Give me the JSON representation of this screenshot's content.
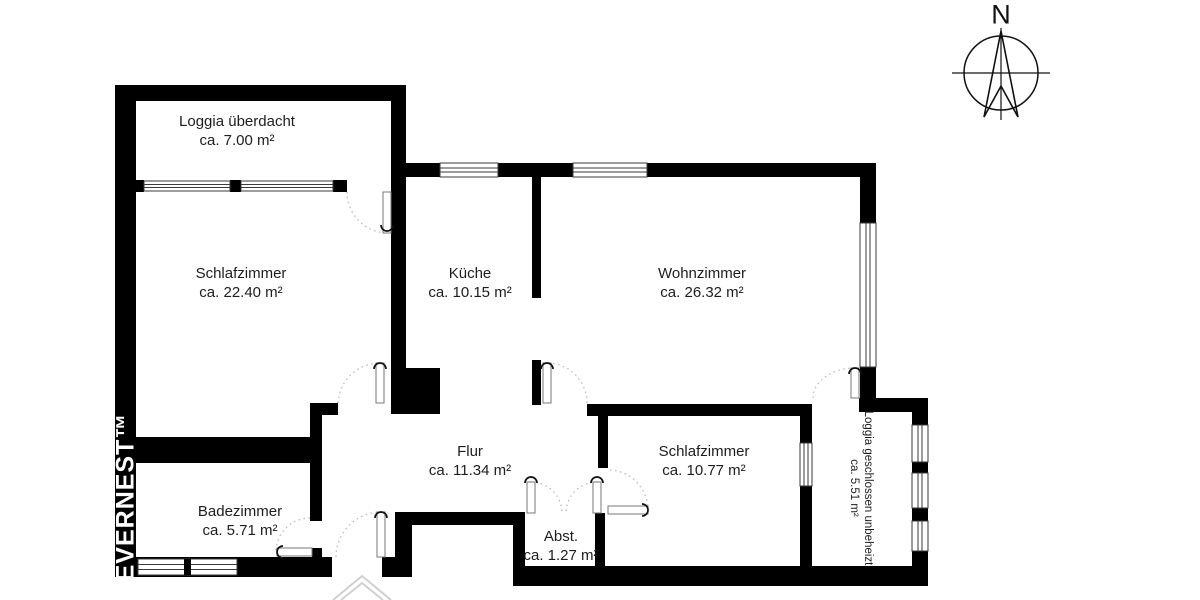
{
  "title": "Grundriss / floor plan",
  "colors": {
    "wall": "#000000",
    "background": "#ffffff",
    "door_arc": "#c2c2c2",
    "window_line": "#3a3a3a",
    "label_text": "#1d1d1d",
    "watermark_text": "#ffffff",
    "entrance_chevron": "#d0d0d0"
  },
  "compass": {
    "label": "N"
  },
  "watermark": {
    "text": "EVERNEST™"
  },
  "rooms": [
    {
      "id": "loggia-covered",
      "name": "Loggia überdacht",
      "area": "ca. 7.00 m²"
    },
    {
      "id": "bedroom-1",
      "name": "Schlafzimmer",
      "area": "ca. 22.40 m²"
    },
    {
      "id": "kitchen",
      "name": "Küche",
      "area": "ca. 10.15 m²"
    },
    {
      "id": "living-room",
      "name": "Wohnzimmer",
      "area": "ca. 26.32 m²"
    },
    {
      "id": "hallway",
      "name": "Flur",
      "area": "ca. 11.34 m²"
    },
    {
      "id": "bedroom-2",
      "name": "Schlafzimmer",
      "area": "ca. 10.77 m²"
    },
    {
      "id": "bathroom",
      "name": "Badezimmer",
      "area": "ca. 5.71 m²"
    },
    {
      "id": "storage",
      "name": "Abst.",
      "area": "ca. 1.27 m²"
    },
    {
      "id": "loggia-closed",
      "name": "Loggia geschlossen unbeheizt",
      "area": "ca. 5.51 m²"
    }
  ]
}
